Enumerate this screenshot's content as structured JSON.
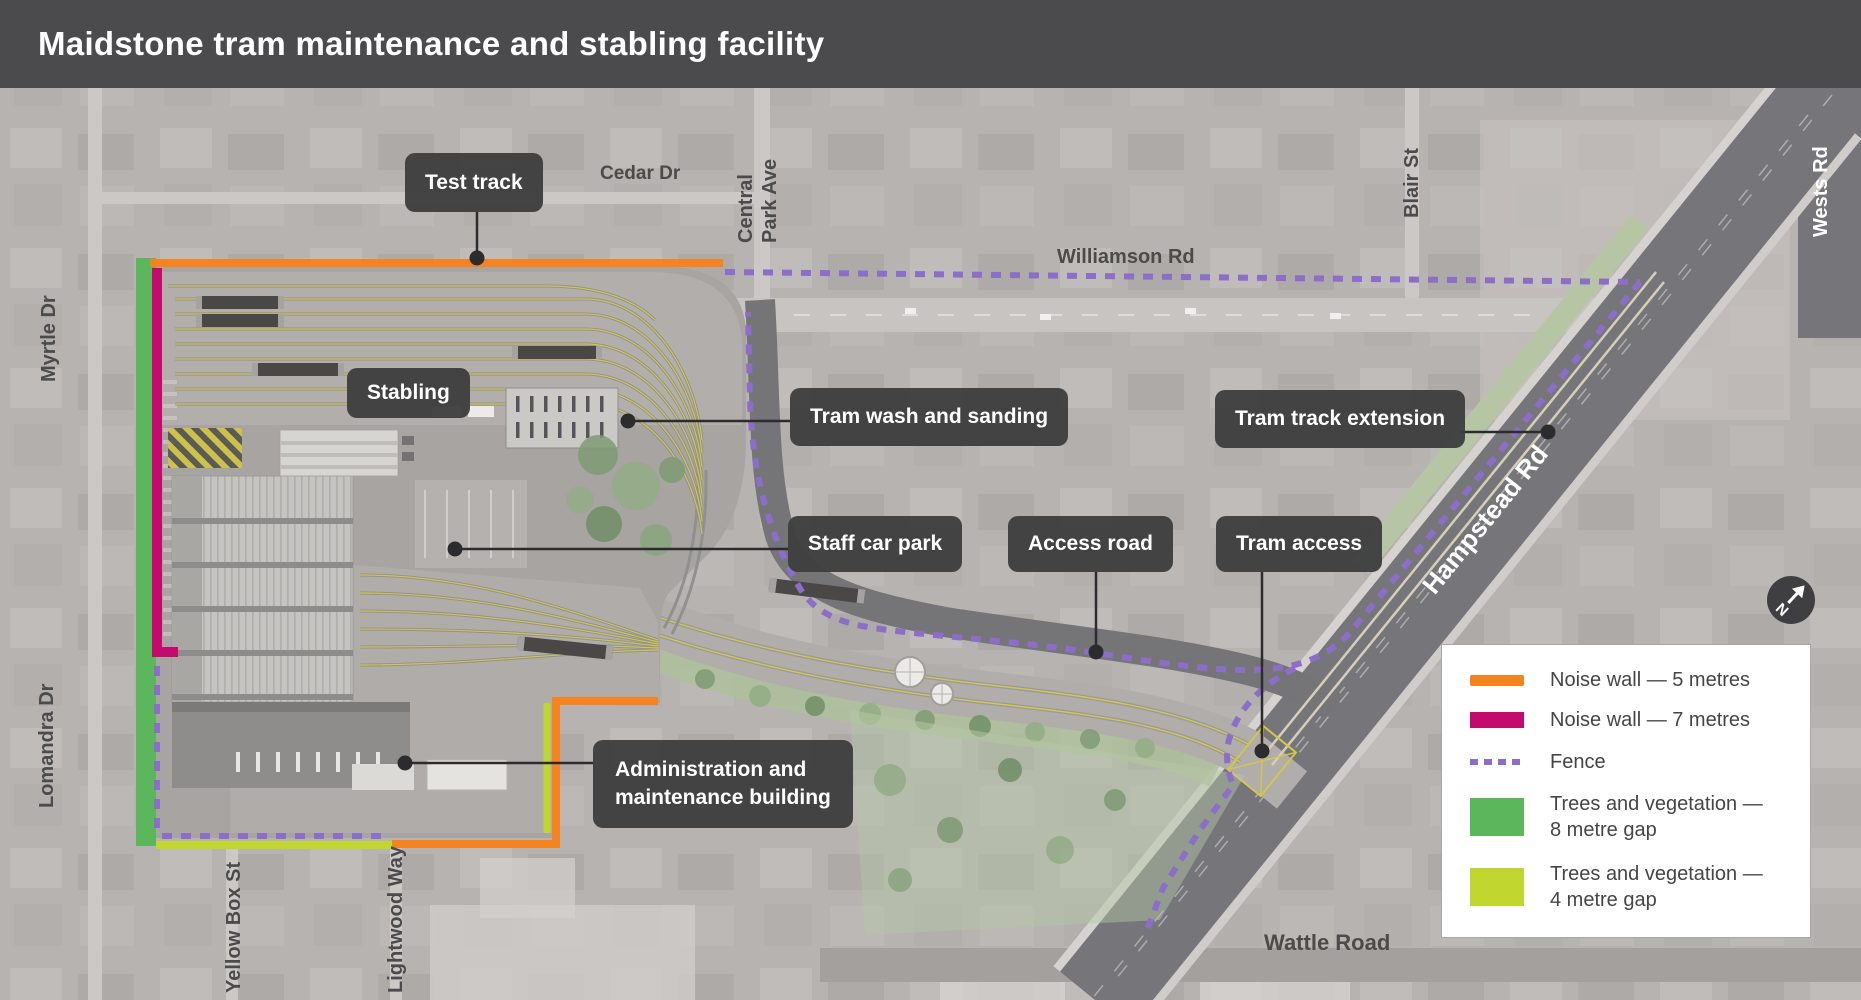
{
  "title": "Maidstone tram maintenance and stabling facility",
  "callouts": {
    "test_track": "Test track",
    "stabling": "Stabling",
    "tram_wash": "Tram wash and sanding",
    "tram_track_extension": "Tram track extension",
    "staff_car_park": "Staff car park",
    "access_road": "Access road",
    "tram_access": "Tram access",
    "admin_line1": "Administration and",
    "admin_line2": "maintenance building"
  },
  "roads": {
    "cedar": "Cedar Dr",
    "central_park_line1": "Central",
    "central_park_line2": "Park Ave",
    "williamson": "Williamson Rd",
    "blair": "Blair St",
    "wests": "Wests Rd",
    "myrtle": "Myrtle Dr",
    "lomandra": "Lomandra Dr",
    "yellow_box": "Yellow Box St",
    "lightwood": "Lightwood Way",
    "hampstead": "Hampstead Rd",
    "wattle": "Wattle Road"
  },
  "legend": {
    "noise_wall_5": "Noise wall — 5 metres",
    "noise_wall_7": "Noise wall — 7 metres",
    "fence": "Fence",
    "trees_8_line1": "Trees and vegetation —",
    "trees_8_line2": "8 metre gap",
    "trees_4_line1": "Trees and vegetation —",
    "trees_4_line2": "4 metre gap"
  },
  "compass": {
    "north": "N"
  },
  "colors": {
    "title_bar": "#4B4B4D",
    "label_box": "#3E3E40",
    "noise_wall_5m": "#F5831F",
    "noise_wall_7m": "#C40A6C",
    "fence": "#8C6EC9",
    "trees_8m_gap": "#5CB75C",
    "trees_4m_gap": "#C1D62F"
  }
}
